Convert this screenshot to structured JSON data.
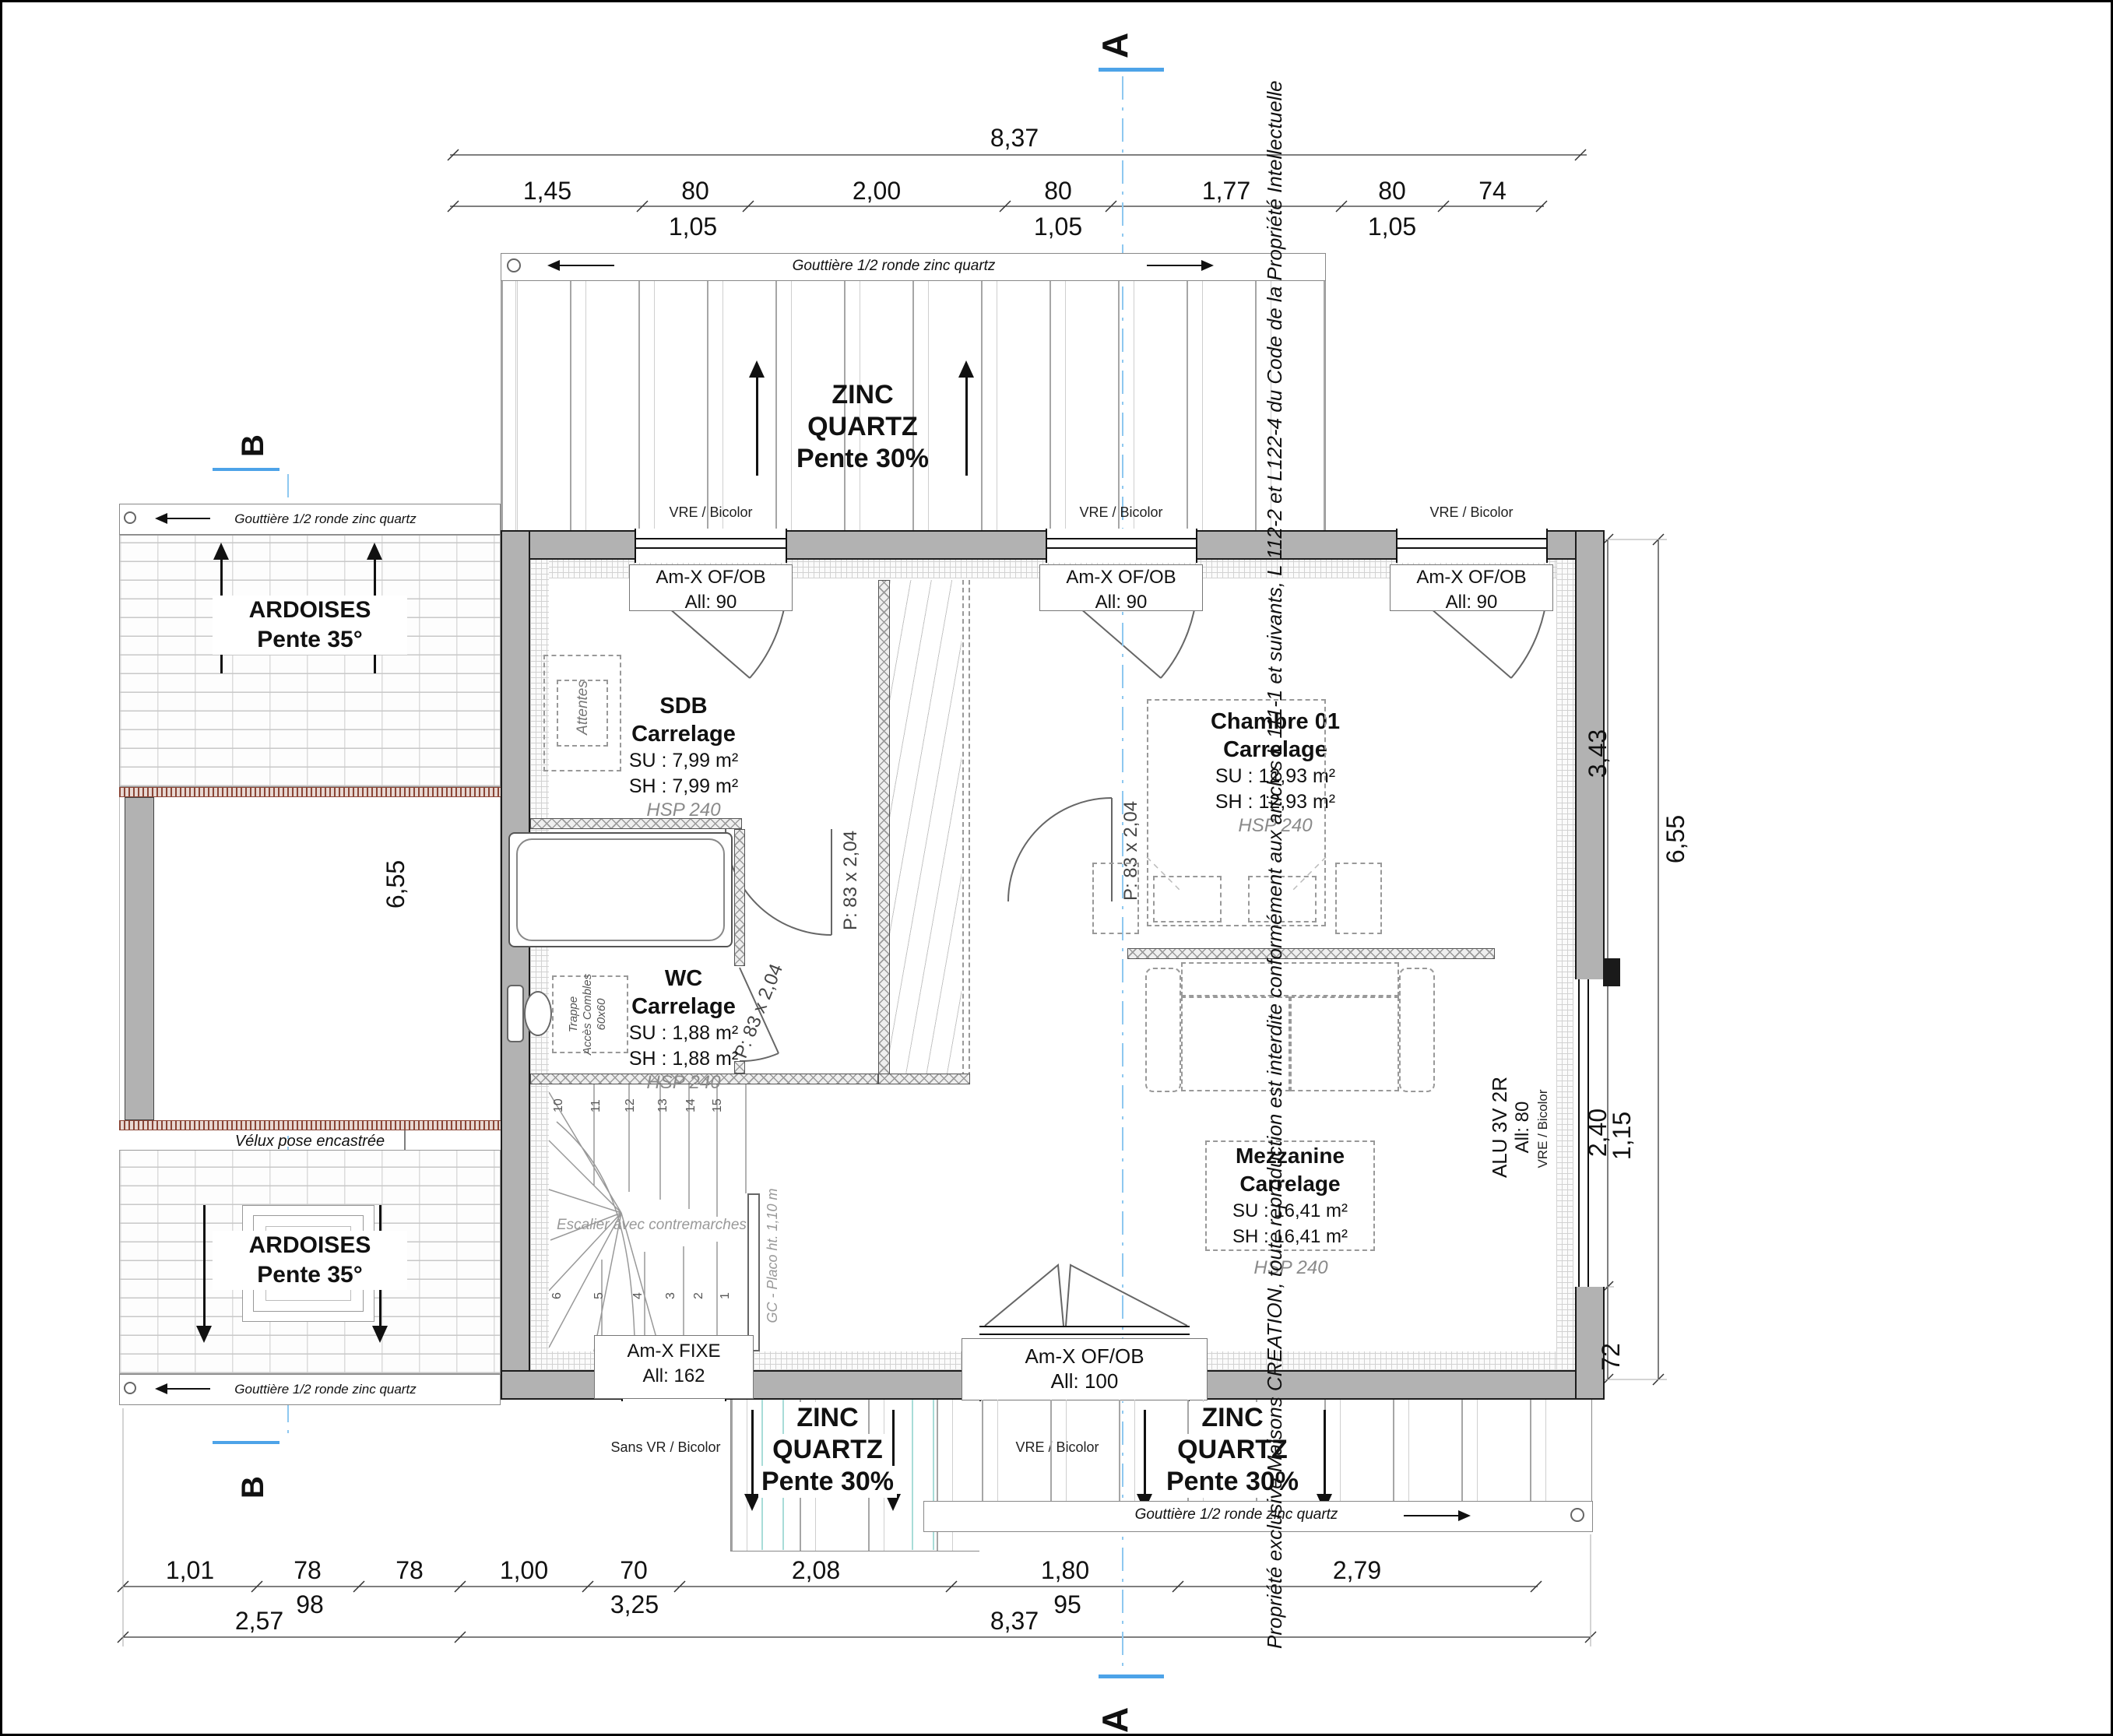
{
  "copyright": "Propriété exclusive Maisons CREATION, toute reproduction est interdite conformément aux articles L 111-1 et suivants, L 112-2 et L122-4 du Code de la Propriété Intellectuelle",
  "sections": {
    "a": "A",
    "b": "B"
  },
  "roof": {
    "zinc1": "ZINC",
    "zinc2": "QUARTZ",
    "zinc_slope": "Pente 30%",
    "ard1": "ARDOISES",
    "ard_slope": "Pente 35°",
    "gutter": "Gouttière 1/2 ronde zinc quartz",
    "velux": "Vélux pose encastrée"
  },
  "rooms": {
    "sdb": {
      "name": "SDB",
      "finish": "Carrelage",
      "su": "SU : 7,99 m²",
      "sh": "SH : 7,99 m²",
      "hsp": "HSP 240"
    },
    "wc": {
      "name": "WC",
      "finish": "Carrelage",
      "su": "SU : 1,88 m²",
      "sh": "SH : 1,88 m²",
      "hsp": "HSP 240"
    },
    "chambre": {
      "name": "Chambre 01",
      "finish": "Carrelage",
      "su": "SU : 12,93 m²",
      "sh": "SH : 12,93 m²",
      "hsp": "HSP 240"
    },
    "mezzanine": {
      "name": "Mezzanine",
      "finish": "Carrelage",
      "su": "SU : 16,41 m²",
      "sh": "SH : 16,41 m²",
      "hsp": "HSP 240"
    }
  },
  "openings": {
    "of_ob_90": {
      "l1": "Am-X OF/OB",
      "l2": "All: 90"
    },
    "fixe_162": {
      "l1": "Am-X FIXE",
      "l2": "All: 162"
    },
    "of_ob_100": {
      "l1": "Am-X OF/OB",
      "l2": "All: 100"
    },
    "alu": {
      "l1": "ALU 3V 2R",
      "l2": "All: 80"
    },
    "vre": "VRE / Bicolor",
    "sans_vr": "Sans VR / Bicolor",
    "door": "P: 83 x 2,04",
    "trappe1": "Trappe",
    "trappe2": "Accès Combles",
    "trappe3": "60x60",
    "attentes": "Attentes"
  },
  "stairs": {
    "label": "Escalier avec contremarches",
    "gc": "GC - Placo ht. 1,10 m",
    "top": [
      "10",
      "11",
      "12",
      "13",
      "14",
      "15"
    ],
    "bottom": [
      "6",
      "5",
      "4",
      "3",
      "2",
      "1"
    ]
  },
  "dims": {
    "top_total": "8,37",
    "top": [
      "1,45",
      "80",
      "2,00",
      "80",
      "1,77",
      "80",
      "74"
    ],
    "top_sub": [
      "1,05",
      "1,05",
      "1,05"
    ],
    "bottom": [
      "1,01",
      "78",
      "78",
      "1,00",
      "70",
      "2,08",
      "1,80",
      "2,79"
    ],
    "bottom_sub": [
      "98",
      "3,25",
      "95"
    ],
    "bottom2": [
      "2,57",
      "8,37"
    ],
    "right": {
      "r1": "3,43",
      "r2": "2,40",
      "r3": "1,15",
      "r4": "72",
      "r5": "6,55"
    },
    "left": "6,55"
  }
}
